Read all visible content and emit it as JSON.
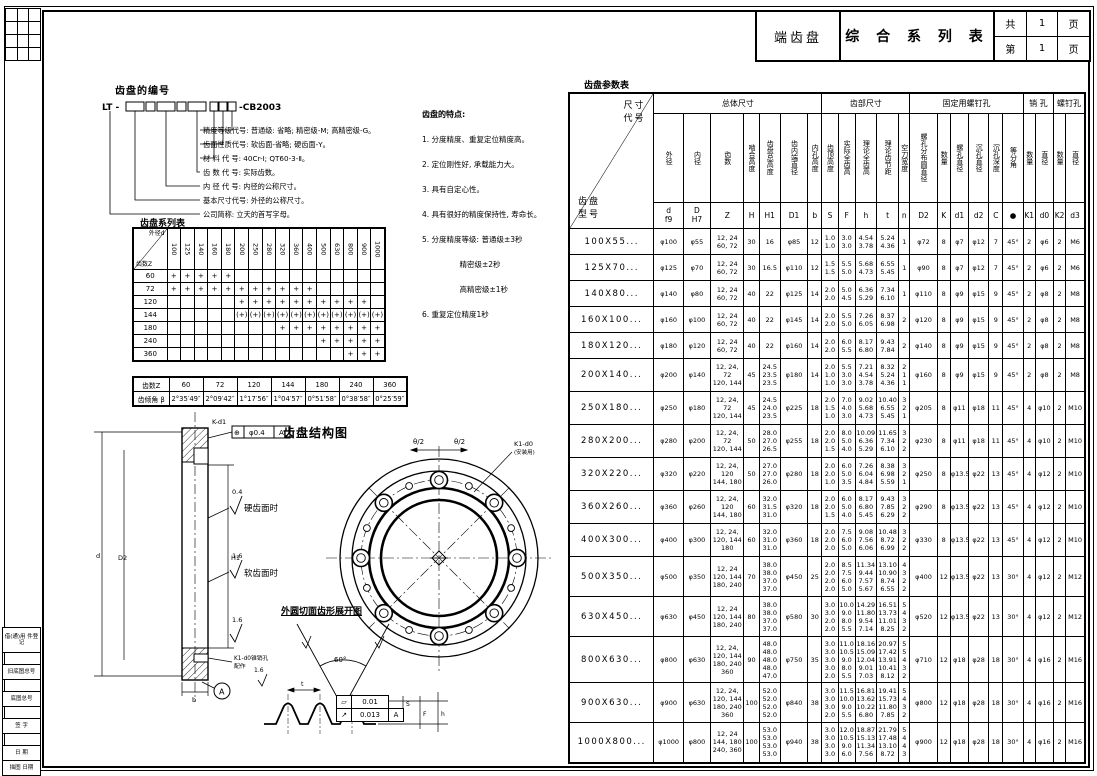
{
  "title_block": {
    "part_name": "端齿盘",
    "doc_title": "综 合 系 列 表",
    "total_label": "共",
    "total_pages": "1",
    "page_unit": "页",
    "current_label": "第",
    "current_page": "1",
    "page_unit2": "页"
  },
  "numbering": {
    "heading": "齿盘的编号",
    "code_prefix": "LT -",
    "code_suffix": "-CB2003",
    "descriptions": [
      "精度等级代号: 普通级: 省略; 精密级-M; 高精密级-G。",
      "齿面性质代号: 软齿面-省略; 硬齿面-Y。",
      "材 料 代 号: 40Cr-Ⅰ; QT60-3-Ⅱ。",
      "齿 数 代 号: 实际齿数。",
      "内 径 代 号: 内径的公称尺寸。",
      "基本尺寸代号: 外径的公称尺寸。",
      "公司简称: 立天的首写字母。"
    ]
  },
  "features": {
    "heading": "齿盘的特点:",
    "items": [
      "1. 分度精度、重复定位精度高。",
      "2. 定位刚性好, 承载能力大。",
      "3. 具有自定心性。",
      "4. 具有很好的精度保持性, 寿命长。",
      "5. 分度精度等级: 普通级±3秒",
      "　　　　　精密级±2秒",
      "　　　　　高精密级±1秒",
      "6. 重复定位精度1秒"
    ]
  },
  "series_table": {
    "title": "齿盘系列表",
    "corner_top": "外径d",
    "corner_bottom": "齿数Z",
    "columns": [
      "100",
      "125",
      "140",
      "160",
      "180",
      "200",
      "250",
      "280",
      "320",
      "360",
      "400",
      "500",
      "630",
      "800",
      "900",
      "1000"
    ],
    "rows": [
      {
        "h": 12,
        "cells": [
          "60",
          "+",
          "+",
          "+",
          "+",
          "+",
          "",
          "",
          "",
          "",
          "",
          "",
          "",
          "",
          "",
          "",
          ""
        ]
      },
      {
        "h": 12,
        "cells": [
          "72",
          "+",
          "+",
          "+",
          "+",
          "+",
          "+",
          "+",
          "+",
          "+",
          "+",
          "+",
          "",
          "",
          "",
          "",
          ""
        ]
      },
      {
        "h": 12,
        "cells": [
          "120",
          "",
          "",
          "",
          "",
          "",
          "+",
          "+",
          "+",
          "+",
          "+",
          "+",
          "+",
          "+",
          "+",
          "+",
          ""
        ]
      },
      {
        "h": 12,
        "cells": [
          "144",
          "",
          "",
          "",
          "",
          "",
          "(+)",
          "(+)",
          "(+)",
          "(+)",
          "(+)",
          "(+)",
          "(+)",
          "(+)",
          "(+)",
          "(+)",
          "(+)"
        ]
      },
      {
        "h": 12,
        "cells": [
          "180",
          "",
          "",
          "",
          "",
          "",
          "",
          "",
          "",
          "+",
          "+",
          "+",
          "+",
          "+",
          "+",
          "+",
          "+"
        ]
      },
      {
        "h": 12,
        "cells": [
          "240",
          "",
          "",
          "",
          "",
          "",
          "",
          "",
          "",
          "",
          "",
          "",
          "+",
          "+",
          "+",
          "+",
          "+"
        ]
      },
      {
        "h": 12,
        "cells": [
          "360",
          "",
          "",
          "",
          "",
          "",
          "",
          "",
          "",
          "",
          "",
          "",
          "",
          "",
          "+",
          "+",
          "+"
        ]
      }
    ]
  },
  "angle_table": {
    "rows": [
      {
        "h": 13,
        "cells": [
          "齿数Z",
          "60",
          "72",
          "120",
          "144",
          "180",
          "240",
          "360"
        ]
      },
      {
        "h": 13,
        "cells": [
          "齿倾角 β",
          "2°35′49″",
          "2°09′42″",
          "1°17′56″",
          "1°04′57″",
          "0°51′58″",
          "0°38′58″",
          "0°25′59″"
        ]
      }
    ]
  },
  "structure": {
    "title": "齿盘结构图",
    "theta_left": "θ/2",
    "theta_right": "θ/2",
    "callout": "K1-d0",
    "callout2": "(安装用)"
  },
  "development": {
    "title": "外圆切面齿形展开图",
    "angle": "60°",
    "dim_t": "t",
    "dim_s": "S",
    "dim_f": "F",
    "dim_h": "h",
    "ra": "1.6"
  },
  "section_view": {
    "ra_hard": "0.4",
    "hard_label": "硬齿面时",
    "ra_soft": "1.6",
    "soft_label": "软齿面时",
    "ra_bottom": "1.6",
    "k_d1": "K-d1",
    "pos_symbol": "⊕",
    "pos_tol": "φ0.4",
    "pos_datum": "A",
    "pin_note": "K1-d0锥销孔",
    "pin_note2": "配作",
    "datum": "A",
    "dim_d": "d",
    "dim_d2": "D2",
    "dim_h1": "H1",
    "dim_b": "b"
  },
  "tolerance_frames": {
    "flatness_symbol": "▱",
    "flatness": "0.01",
    "runout_symbol": "↗",
    "runout": "0.013",
    "runout_datum": "A"
  },
  "param_table": {
    "title": "齿盘参数表",
    "corner_top": "尺寸\n代号",
    "corner_bottom": "齿盘\n型号",
    "groups": [
      "总体尺寸",
      "齿部尺寸",
      "固定用螺钉孔",
      "销 孔",
      "螺钉孔"
    ],
    "col_headers": [
      "外径",
      "内径",
      "齿数",
      "啮合高度",
      "齿盘总高度",
      "齿内端直径",
      "内孔高度",
      "齿顶高度",
      "实际全齿高",
      "理论全齿高",
      "理论齿节距",
      "空刀宽度",
      "螺孔分布圆直径",
      "数量",
      "螺孔直径",
      "沉孔直径",
      "沉孔深度",
      "等分角",
      "数量",
      "直径",
      "数量",
      "直径"
    ],
    "symbols": [
      "d\nf9",
      "D\nH7",
      "Z",
      "H",
      "H1",
      "D1",
      "b",
      "S",
      "F",
      "h",
      "t",
      "n",
      "D2",
      "K",
      "d1",
      "d2",
      "C",
      "●",
      "K1",
      "d0",
      "K2",
      "d3"
    ],
    "rows": [
      {
        "h": 26,
        "cells": [
          "100X55...",
          "φ100",
          "φ55",
          "12, 24\n60, 72",
          "30",
          "16",
          "φ85",
          "12",
          "1.0\n1.0",
          "3.0\n3.0",
          "4.54\n3.78",
          "5.24\n4.36",
          "1",
          "φ72",
          "8",
          "φ7",
          "φ12",
          "7",
          "45°",
          "2",
          "φ6",
          "2",
          "M6"
        ]
      },
      {
        "h": 26,
        "cells": [
          "125X70...",
          "φ125",
          "φ70",
          "12, 24\n60, 72",
          "30",
          "16.5",
          "φ110",
          "12",
          "1.5\n1.5",
          "5.5\n5.0",
          "5.68\n4.73",
          "6.55\n5.45",
          "1",
          "φ90",
          "8",
          "φ7",
          "φ12",
          "7",
          "45°",
          "2",
          "φ6",
          "2",
          "M6"
        ]
      },
      {
        "h": 26,
        "cells": [
          "140X80...",
          "φ140",
          "φ80",
          "12, 24\n60, 72",
          "40",
          "22",
          "φ125",
          "14",
          "2.0\n2.0",
          "5.0\n4.5",
          "6.36\n5.29",
          "7.34\n6.10",
          "1",
          "φ110",
          "8",
          "φ9",
          "φ15",
          "9",
          "45°",
          "2",
          "φ8",
          "2",
          "M8"
        ]
      },
      {
        "h": 26,
        "cells": [
          "160X100...",
          "φ160",
          "φ100",
          "12, 24\n60, 72",
          "40",
          "22",
          "φ145",
          "14",
          "2.0\n2.0",
          "5.5\n5.0",
          "7.26\n6.05",
          "8.37\n6.98",
          "2",
          "φ120",
          "8",
          "φ9",
          "φ15",
          "9",
          "45°",
          "2",
          "φ8",
          "2",
          "M8"
        ]
      },
      {
        "h": 26,
        "cells": [
          "180X120...",
          "φ180",
          "φ120",
          "12, 24\n60, 72",
          "40",
          "22",
          "φ160",
          "14",
          "2.0\n2.0",
          "6.0\n5.5",
          "8.17\n6.80",
          "9.43\n7.84",
          "2",
          "φ140",
          "8",
          "φ9",
          "φ15",
          "9",
          "45°",
          "2",
          "φ8",
          "2",
          "M8"
        ]
      },
      {
        "h": 33,
        "cells": [
          "200X140...",
          "φ200",
          "φ140",
          "12, 24, 72\n120, 144",
          "45",
          "24.5\n23.5\n23.5",
          "φ180",
          "14",
          "2.0\n1.0\n1.0",
          "5.5\n3.0\n3.0",
          "7.21\n4.54\n3.78",
          "8.32\n5.24\n4.36",
          "2\n1\n1",
          "φ160",
          "8",
          "φ9",
          "φ15",
          "9",
          "45°",
          "2",
          "φ8",
          "2",
          "M8"
        ]
      },
      {
        "h": 33,
        "cells": [
          "250X180...",
          "φ250",
          "φ180",
          "12, 24, 72\n120, 144",
          "45",
          "24.5\n24.0\n23.5",
          "φ225",
          "18",
          "2.0\n1.5\n1.0",
          "7.0\n4.0\n3.0",
          "9.02\n5.68\n4.73",
          "10.40\n6.55\n5.45",
          "3\n2\n1",
          "φ205",
          "8",
          "φ11",
          "φ18",
          "11",
          "45°",
          "4",
          "φ10",
          "2",
          "M10"
        ]
      },
      {
        "h": 33,
        "cells": [
          "280X200...",
          "φ280",
          "φ200",
          "12, 24, 72\n120, 144",
          "50",
          "28.0\n27.0\n26.5",
          "φ255",
          "18",
          "2.0\n2.0\n1.5",
          "8.0\n5.0\n4.0",
          "10.09\n6.36\n5.29",
          "11.65\n7.34\n6.10",
          "3\n2\n2",
          "φ230",
          "8",
          "φ11",
          "φ18",
          "11",
          "45°",
          "4",
          "φ10",
          "2",
          "M10"
        ]
      },
      {
        "h": 33,
        "cells": [
          "320X220...",
          "φ320",
          "φ220",
          "12, 24, 120\n144, 180",
          "50",
          "27.0\n27.0\n26.0",
          "φ280",
          "18",
          "2.0\n2.0\n1.0",
          "6.0\n5.0\n3.5",
          "7.26\n6.04\n4.84",
          "8.38\n6.98\n5.59",
          "3\n2\n1",
          "φ250",
          "8",
          "φ13.5",
          "φ22",
          "13",
          "45°",
          "4",
          "φ12",
          "2",
          "M10"
        ]
      },
      {
        "h": 33,
        "cells": [
          "360X260...",
          "φ360",
          "φ260",
          "12, 24, 120\n144, 180",
          "60",
          "32.0\n31.5\n31.0",
          "φ320",
          "18",
          "2.0\n2.0\n1.5",
          "6.0\n5.0\n4.0",
          "8.17\n6.80\n5.45",
          "9.43\n7.85\n6.29",
          "3\n2\n2",
          "φ290",
          "8",
          "φ13.5",
          "φ22",
          "13",
          "45°",
          "4",
          "φ12",
          "2",
          "M10"
        ]
      },
      {
        "h": 33,
        "cells": [
          "400X300...",
          "φ400",
          "φ300",
          "12, 24,\n120, 144\n180",
          "60",
          "32.0\n31.0\n31.0",
          "φ360",
          "18",
          "2.0\n2.0\n2.0",
          "7.5\n6.0\n5.0",
          "9.08\n7.56\n6.06",
          "10.48\n8.72\n6.99",
          "3\n2\n2",
          "φ330",
          "8",
          "φ13.5",
          "φ22",
          "13",
          "45°",
          "4",
          "φ12",
          "2",
          "M10"
        ]
      },
      {
        "h": 40,
        "cells": [
          "500X350...",
          "φ500",
          "φ350",
          "12, 24\n120, 144\n180, 240",
          "70",
          "38.0\n38.0\n37.0\n37.0",
          "φ450",
          "25",
          "2.0\n2.0\n2.0\n2.0",
          "8.5\n7.5\n6.0\n5.0",
          "11.34\n9.44\n7.57\n5.67",
          "13.10\n10.90\n8.74\n6.55",
          "4\n3\n2\n2",
          "φ400",
          "12",
          "φ13.5",
          "φ22",
          "13",
          "30°",
          "4",
          "φ12",
          "2",
          "M12"
        ]
      },
      {
        "h": 40,
        "cells": [
          "630X450...",
          "φ630",
          "φ450",
          "12, 24\n120, 144\n180, 240",
          "80",
          "38.0\n38.0\n37.0\n37.0",
          "φ580",
          "30",
          "3.0\n3.0\n2.0\n2.0",
          "10.0\n9.0\n8.0\n5.5",
          "14.29\n11.80\n9.54\n7.14",
          "16.51\n13.73\n11.01\n8.25",
          "5\n4\n3\n2",
          "φ520",
          "12",
          "φ13.5",
          "φ22",
          "13",
          "30°",
          "4",
          "φ12",
          "2",
          "M12"
        ]
      },
      {
        "h": 46,
        "cells": [
          "800X630...",
          "φ800",
          "φ630",
          "12, 24,\n120, 144\n180, 240\n360",
          "90",
          "48.0\n48.0\n48.0\n48.0\n47.0",
          "φ750",
          "35",
          "3.0\n3.0\n3.0\n3.0\n2.0",
          "11.0\n10.5\n9.0\n8.0\n5.5",
          "18.16\n15.09\n12.04\n9.01\n7.03",
          "20.97\n17.42\n13.91\n10.41\n8.12",
          "5\n5\n4\n3\n2",
          "φ710",
          "12",
          "φ18",
          "φ28",
          "18",
          "30°",
          "4",
          "φ16",
          "2",
          "M16"
        ]
      },
      {
        "h": 40,
        "cells": [
          "900X630...",
          "φ900",
          "φ630",
          "12, 24,\n120, 144\n180, 240\n360",
          "100",
          "52.0\n52.0\n52.0\n52.0",
          "φ840",
          "38",
          "3.0\n3.0\n3.0\n2.0",
          "11.5\n10.0\n9.0\n5.5",
          "16.81\n13.62\n10.22\n6.80",
          "19.41\n15.73\n11.80\n7.85",
          "5\n4\n3\n2",
          "φ800",
          "12",
          "φ18",
          "φ28",
          "18",
          "30°",
          "4",
          "φ16",
          "2",
          "M16"
        ]
      },
      {
        "h": 40,
        "cells": [
          "1000X800...",
          "φ1000",
          "φ800",
          "12, 24\n144, 180\n240, 360",
          "100",
          "53.0\n53.0\n53.0\n53.0",
          "φ940",
          "38",
          "3.0\n3.0\n3.0\n3.0",
          "12.0\n10.5\n9.0\n6.0",
          "18.87\n15.13\n11.34\n7.56",
          "21.79\n17.48\n13.10\n8.72",
          "5\n4\n4\n3",
          "φ900",
          "12",
          "φ18",
          "φ28",
          "18",
          "30°",
          "4",
          "φ16",
          "2",
          "M16"
        ]
      }
    ]
  },
  "margin": {
    "blocks": [
      "借(通)用\n件登记",
      "旧底图总号",
      "底图总号",
      "签  字",
      "日  期",
      "描图    日期"
    ]
  }
}
